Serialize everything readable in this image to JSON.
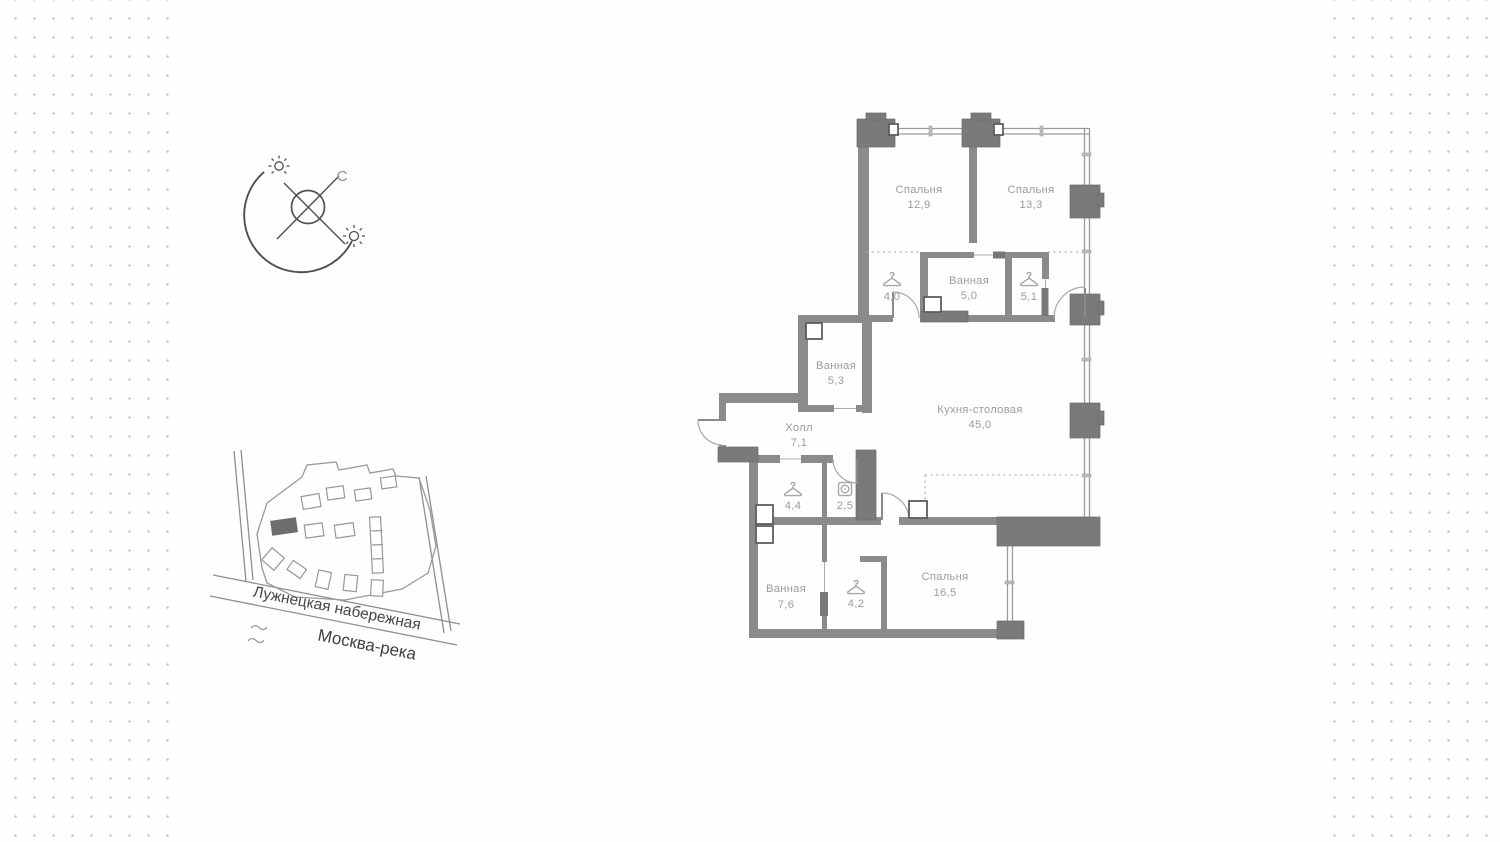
{
  "colors": {
    "wall_dark": "#7a7a7a",
    "wall_medium": "#8b8b8b",
    "label_gray": "#9c9c9c"
  },
  "compass": {
    "north_label": "С"
  },
  "site_map": {
    "street_label": "Лужнецкая набережная",
    "river_label": "Москва-река"
  },
  "floor_plan": {
    "rooms": [
      {
        "id": "bedroom-1",
        "name": "Спальня",
        "area": "12,9"
      },
      {
        "id": "bedroom-2",
        "name": "Спальня",
        "area": "13,3"
      },
      {
        "id": "wardrobe-1",
        "name": "",
        "area": "4,0",
        "icon": "hanger"
      },
      {
        "id": "bathroom-1",
        "name": "Ванная",
        "area": "5,0"
      },
      {
        "id": "wardrobe-2",
        "name": "",
        "area": "5,1",
        "icon": "hanger"
      },
      {
        "id": "bathroom-2",
        "name": "Ванная",
        "area": "5,3"
      },
      {
        "id": "hall",
        "name": "Холл",
        "area": "7,1"
      },
      {
        "id": "kitchen",
        "name": "Кухня-столовая",
        "area": "45,0"
      },
      {
        "id": "wardrobe-3",
        "name": "",
        "area": "4,4",
        "icon": "hanger"
      },
      {
        "id": "laundry",
        "name": "",
        "area": "2,5",
        "icon": "washer"
      },
      {
        "id": "bathroom-3",
        "name": "Ванная",
        "area": "7,6"
      },
      {
        "id": "wardrobe-4",
        "name": "",
        "area": "4,2",
        "icon": "hanger"
      },
      {
        "id": "bedroom-3",
        "name": "Спальня",
        "area": "16,5"
      }
    ]
  }
}
